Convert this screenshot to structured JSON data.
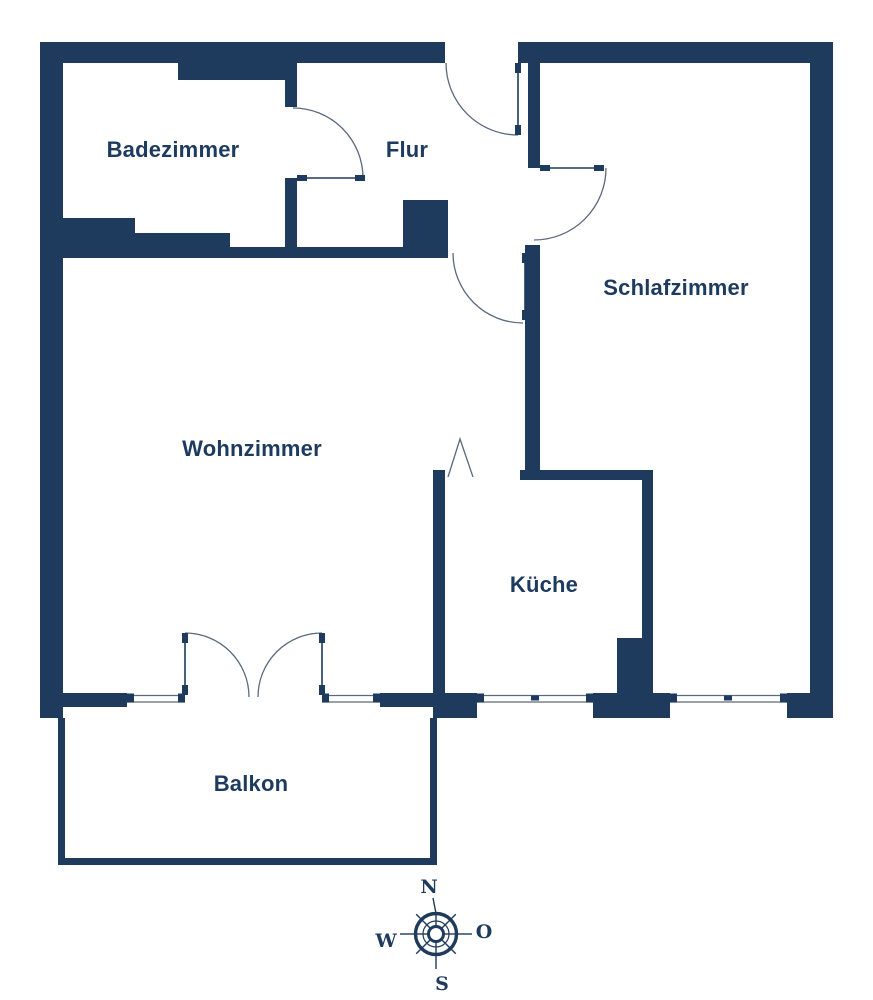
{
  "colors": {
    "background": "#ffffff",
    "wall": "#1e3a5c",
    "line": "#5a6a7e",
    "text": "#1d3a5f"
  },
  "canvas": {
    "width": 873,
    "height": 1000
  },
  "rooms": [
    {
      "id": "badezimmer",
      "label": "Badezimmer",
      "x": 173,
      "y": 157
    },
    {
      "id": "flur",
      "label": "Flur",
      "x": 407,
      "y": 157
    },
    {
      "id": "schlafzimmer",
      "label": "Schlafzimmer",
      "x": 676,
      "y": 295
    },
    {
      "id": "wohnzimmer",
      "label": "Wohnzimmer",
      "x": 252,
      "y": 456
    },
    {
      "id": "kueche",
      "label": "Küche",
      "x": 544,
      "y": 592
    },
    {
      "id": "balkon",
      "label": "Balkon",
      "x": 251,
      "y": 791
    }
  ],
  "walls": [
    {
      "x": 40,
      "y": 42,
      "w": 405,
      "h": 21
    },
    {
      "x": 518,
      "y": 42,
      "w": 315,
      "h": 21
    },
    {
      "x": 40,
      "y": 42,
      "w": 23,
      "h": 676
    },
    {
      "x": 810,
      "y": 42,
      "w": 23,
      "h": 676
    },
    {
      "x": 178,
      "y": 63,
      "w": 119,
      "h": 17
    },
    {
      "x": 285,
      "y": 63,
      "w": 12,
      "h": 44
    },
    {
      "x": 285,
      "y": 178,
      "w": 12,
      "h": 80
    },
    {
      "x": 63,
      "y": 218,
      "w": 72,
      "h": 29
    },
    {
      "x": 135,
      "y": 233,
      "w": 95,
      "h": 14
    },
    {
      "x": 63,
      "y": 247,
      "w": 385,
      "h": 11
    },
    {
      "x": 403,
      "y": 200,
      "w": 45,
      "h": 47
    },
    {
      "x": 528,
      "y": 63,
      "w": 12,
      "h": 105
    },
    {
      "x": 525,
      "y": 245,
      "w": 15,
      "h": 225
    },
    {
      "x": 520,
      "y": 470,
      "w": 133,
      "h": 10
    },
    {
      "x": 642,
      "y": 480,
      "w": 11,
      "h": 213
    },
    {
      "x": 617,
      "y": 638,
      "w": 25,
      "h": 55
    },
    {
      "x": 433,
      "y": 470,
      "w": 12,
      "h": 223
    },
    {
      "x": 63,
      "y": 693,
      "w": 64,
      "h": 14
    },
    {
      "x": 380,
      "y": 693,
      "w": 53,
      "h": 14
    },
    {
      "x": 433,
      "y": 693,
      "w": 44,
      "h": 25
    },
    {
      "x": 593,
      "y": 693,
      "w": 77,
      "h": 25
    },
    {
      "x": 787,
      "y": 693,
      "w": 46,
      "h": 25
    },
    {
      "x": 58,
      "y": 718,
      "w": 7,
      "h": 147
    },
    {
      "x": 58,
      "y": 858,
      "w": 379,
      "h": 7
    },
    {
      "x": 430,
      "y": 718,
      "w": 7,
      "h": 147
    }
  ],
  "windows": {
    "line_ys": [
      695.5,
      702
    ],
    "cap": {
      "y": 693.5,
      "w": 7,
      "h": 9
    },
    "tick": {
      "y": 695.5,
      "w": 8,
      "h": 5
    },
    "items": [
      {
        "x1": 127,
        "x2": 185,
        "caps": [
          127,
          178
        ],
        "ticks": []
      },
      {
        "x1": 322,
        "x2": 380,
        "caps": [
          322,
          373
        ],
        "ticks": []
      },
      {
        "x1": 477,
        "x2": 593,
        "caps": [
          477,
          586
        ],
        "ticks": [
          531
        ]
      },
      {
        "x1": 670,
        "x2": 787,
        "caps": [
          670,
          780
        ],
        "ticks": [
          724
        ]
      }
    ]
  },
  "doors": [
    {
      "name": "entrance-door",
      "leaf": [
        518,
        63,
        518,
        133
      ],
      "arc": "M446,63 A72,72 0 0 0 518,135",
      "caps": [
        [
          515,
          63,
          6,
          10
        ],
        [
          515,
          125,
          6,
          10
        ]
      ]
    },
    {
      "name": "bathroom-door",
      "leaf": [
        297,
        178,
        365,
        178
      ],
      "arc": "M293,108 A70,70 0 0 1 363,178",
      "caps": [
        [
          297,
          175,
          10,
          6
        ],
        [
          355,
          175,
          10,
          6
        ]
      ]
    },
    {
      "name": "bedroom-door",
      "leaf": [
        540,
        168,
        604,
        168
      ],
      "arc": "M606,168 A72,72 0 0 1 534,240",
      "caps": [
        [
          540,
          165,
          10,
          6
        ],
        [
          594,
          165,
          10,
          6
        ]
      ]
    },
    {
      "name": "living-room-door",
      "leaf": [
        525,
        253,
        525,
        320
      ],
      "arc": "M453,253 A70,70 0 0 0 523,323",
      "caps": [
        [
          522,
          253,
          6,
          10
        ],
        [
          522,
          310,
          6,
          10
        ]
      ]
    },
    {
      "name": "balcony-door-left",
      "leaf": [
        185,
        633,
        185,
        695
      ],
      "arc": "M185,633 A64,64 0 0 1 249,697",
      "caps": [
        [
          182,
          633,
          6,
          10
        ],
        [
          182,
          685,
          6,
          10
        ]
      ]
    },
    {
      "name": "balcony-door-right",
      "leaf": [
        322,
        633,
        322,
        695
      ],
      "arc": "M322,633 A64,64 0 0 0 258,697",
      "caps": [
        [
          319,
          633,
          6,
          10
        ],
        [
          319,
          685,
          6,
          10
        ]
      ]
    }
  ],
  "passage": {
    "name": "kitchen-opening-marker",
    "points": "448,477 460,439 473,477"
  },
  "compass": {
    "cx": 436,
    "cy": 934,
    "rings": [
      {
        "r": 20.5,
        "sw": 3.4
      },
      {
        "r": 13,
        "sw": 1.2
      },
      {
        "r": 7.5,
        "sw": 3.0
      }
    ],
    "lines": [
      [
        444,
        934,
        455,
        934
      ],
      [
        441.7,
        928.3,
        449.4,
        920.6
      ],
      [
        436,
        926,
        436,
        915
      ],
      [
        430.3,
        928.3,
        422.6,
        920.6
      ],
      [
        428,
        934,
        417,
        934
      ],
      [
        430.3,
        939.7,
        422.6,
        947.4
      ],
      [
        436,
        942,
        436,
        953
      ],
      [
        441.7,
        939.7,
        449.4,
        947.4
      ],
      [
        456.5,
        934,
        472,
        934
      ],
      [
        436,
        913.5,
        433,
        898
      ],
      [
        415.5,
        934,
        400,
        934
      ],
      [
        436,
        954.5,
        436,
        969
      ],
      [
        450.5,
        919.5,
        455.8,
        914.2
      ],
      [
        421.5,
        919.5,
        416.2,
        914.2
      ],
      [
        421.5,
        948.5,
        416.2,
        953.8
      ],
      [
        450.5,
        948.5,
        455.8,
        953.8
      ]
    ],
    "letters": [
      {
        "t": "N",
        "x": 429,
        "y": 893
      },
      {
        "t": "O",
        "x": 484,
        "y": 938
      },
      {
        "t": "S",
        "x": 442,
        "y": 990
      },
      {
        "t": "W",
        "x": 386,
        "y": 947
      }
    ]
  }
}
